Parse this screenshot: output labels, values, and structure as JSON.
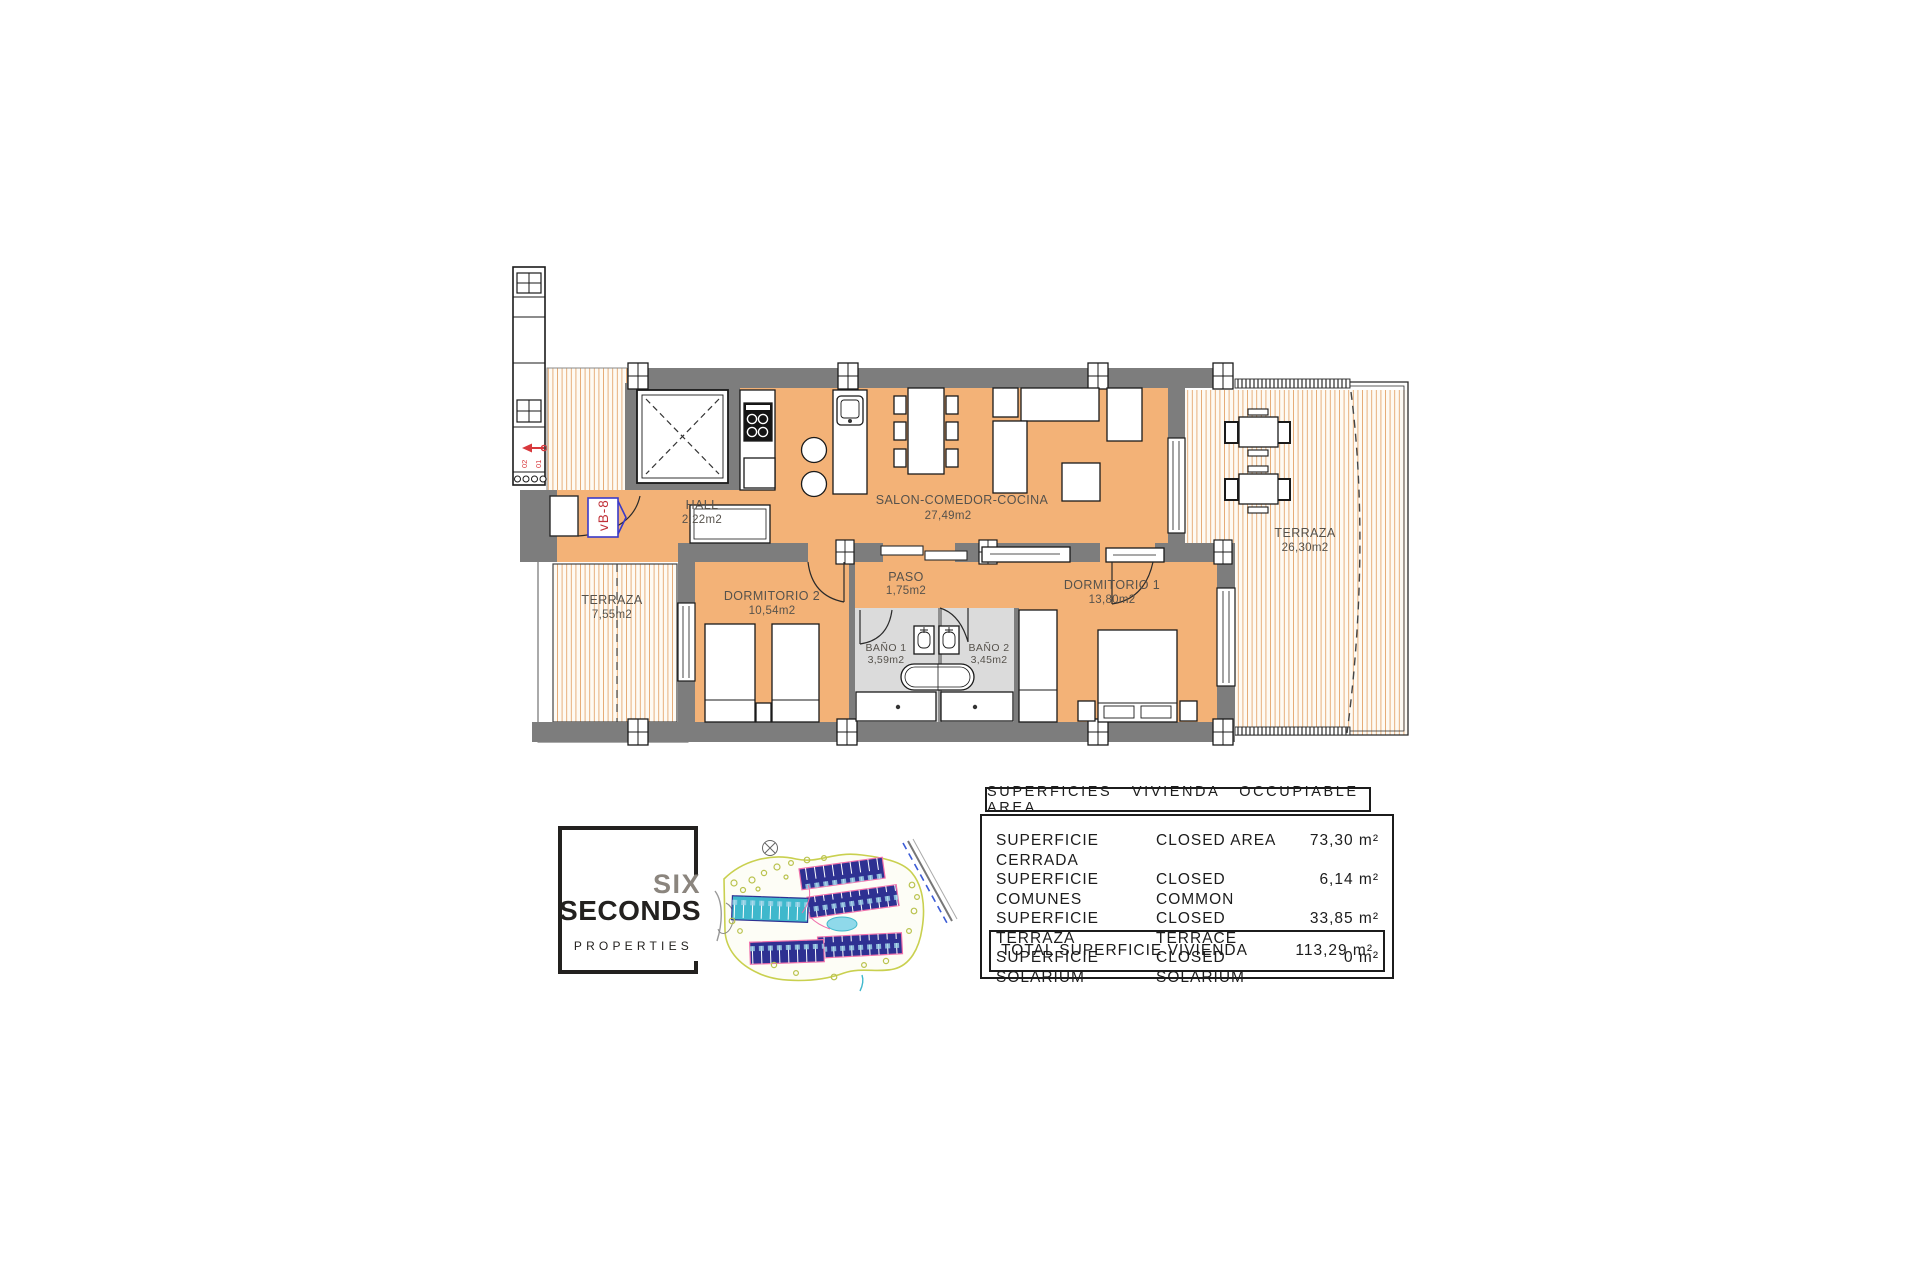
{
  "plan": {
    "unit_badge": "vB-8",
    "markers": {
      "m1": "02",
      "m2": "01"
    },
    "rooms": {
      "hall": {
        "name": "HALL",
        "area": "2,22m2"
      },
      "salon": {
        "name": "SALON-COMEDOR-COCINA",
        "area": "27,49m2"
      },
      "terraza_left": {
        "name": "TERRAZA",
        "area": "7,55m2"
      },
      "terraza_right": {
        "name": "TERRAZA",
        "area": "26,30m2"
      },
      "dormitorio2": {
        "name": "DORMITORIO 2",
        "area": "10,54m2"
      },
      "paso": {
        "name": "PASO",
        "area": "1,75m2"
      },
      "bano1": {
        "name": "BAÑO 1",
        "area": "3,59m2"
      },
      "bano2": {
        "name": "BAÑO 2",
        "area": "3,45m2"
      },
      "dormitorio1": {
        "name": "DORMITORIO 1",
        "area": "13,80m2"
      }
    }
  },
  "logo": {
    "line1": "SIX",
    "line2": "SECONDS",
    "line3": "PROPERTIES"
  },
  "areas_table": {
    "header": "SUPERFICIES VIVIENDA OCCUPIABLE AREA",
    "rows": [
      {
        "es": "SUPERFICIE CERRADA",
        "en": "CLOSED AREA",
        "value": "73,30 m²"
      },
      {
        "es": "SUPERFICIE COMUNES",
        "en": "CLOSED COMMON",
        "value": "6,14 m²"
      },
      {
        "es": "SUPERFICIE TERRAZA",
        "en": "CLOSED TERRACE",
        "value": "33,85 m²"
      },
      {
        "es": "SUPERFICIE SOLARIUM",
        "en": "CLOSED SOLARIUM",
        "value": "0 m²"
      }
    ],
    "total": {
      "label": "TOTAL SUPERFICIE VIVIENDA",
      "value": "113,29 m²"
    }
  },
  "colors": {
    "floor_orange": "#F3B277",
    "wall_gray": "#7D7D7D",
    "bath_gray": "#DBDBDB",
    "terrace_stripe": "#E5A76F",
    "badge_blue": "#3A3AC8",
    "marker_red": "#D8383C",
    "navy_buildings": "#2E3192",
    "teal_buildings": "#3FB8CC",
    "site_outline_green": "#C9D04F"
  }
}
